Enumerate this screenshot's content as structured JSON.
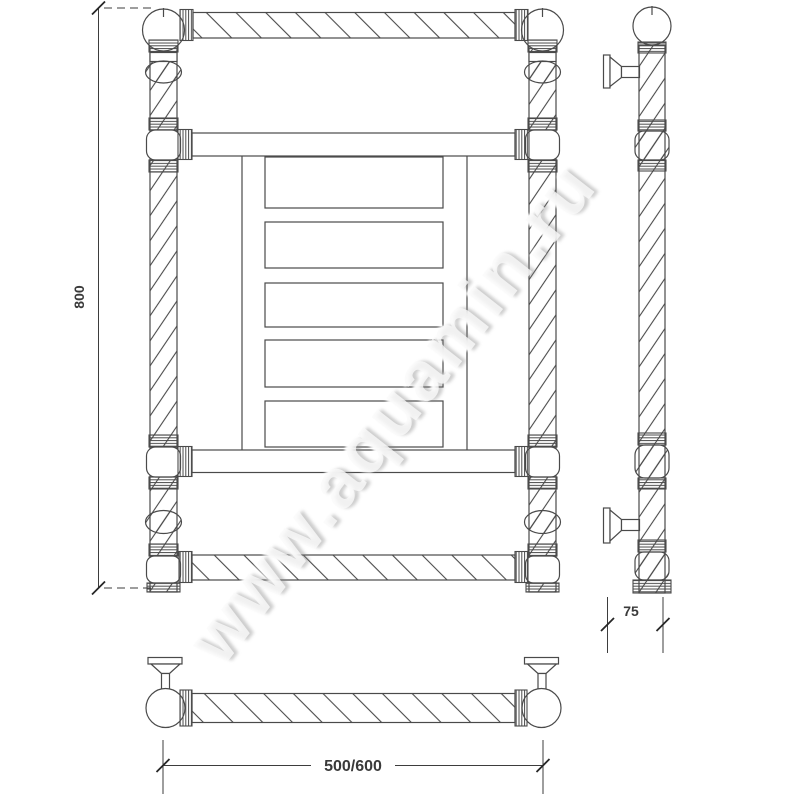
{
  "watermark": {
    "text": "www.aquamin.ru"
  },
  "dimensions": {
    "height_label": "800",
    "depth_label": "75",
    "width_label": "500/600"
  },
  "colors": {
    "background": "#ffffff",
    "line": "#4a4a4a",
    "dimension_text": "#3a3a3a",
    "watermark": "#ededed"
  }
}
